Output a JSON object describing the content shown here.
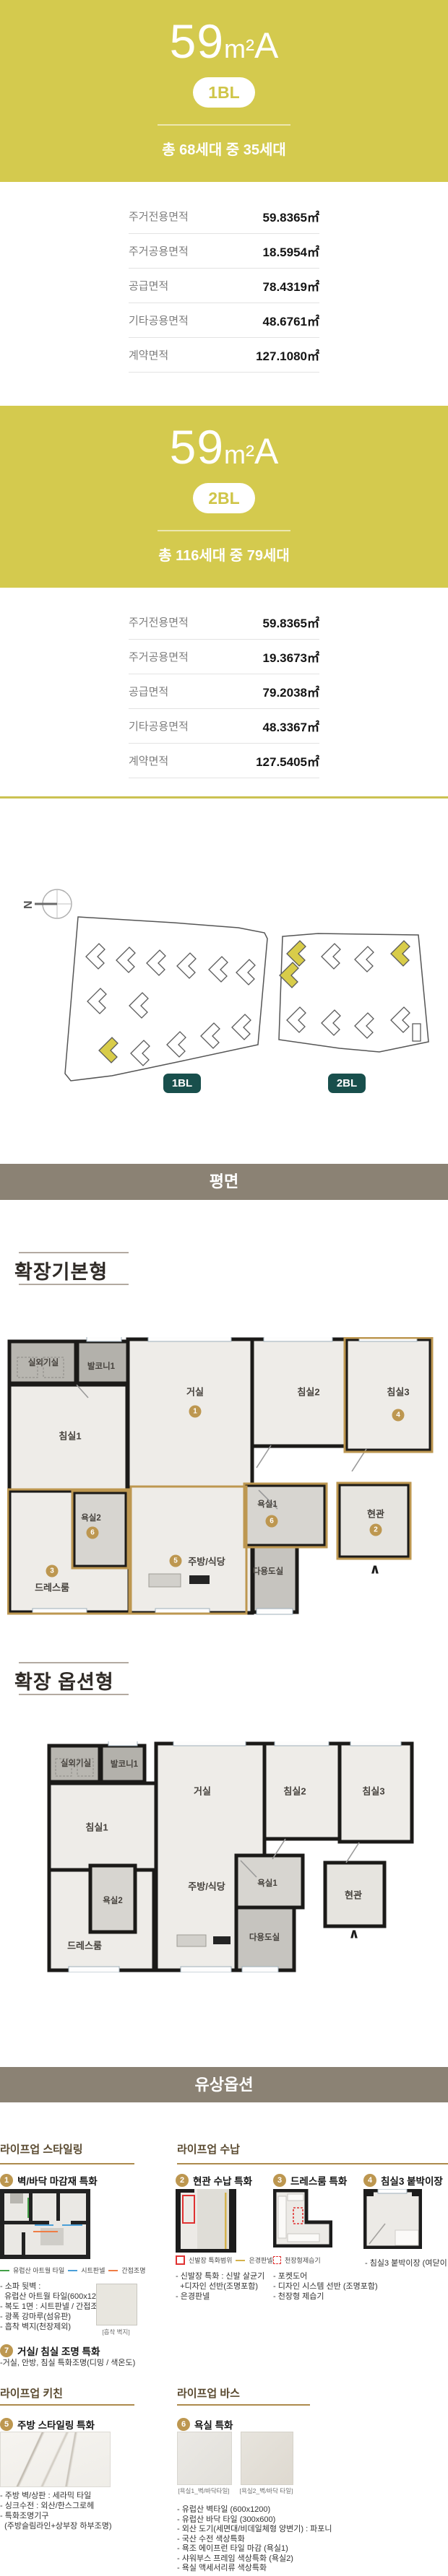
{
  "units": [
    {
      "area_code": "59",
      "area_unit": "m²",
      "type_label": "A",
      "block_badge": "1BL",
      "households": "총 68세대 중 35세대",
      "table": [
        {
          "label": "주거전용면적",
          "value": "59.8365㎡"
        },
        {
          "label": "주거공용면적",
          "value": "18.5954㎡"
        },
        {
          "label": "공급면적",
          "value": "78.4319㎡"
        },
        {
          "label": "기타공용면적",
          "value": "48.6761㎡"
        },
        {
          "label": "계약면적",
          "value": "127.1080㎡"
        }
      ]
    },
    {
      "area_code": "59",
      "area_unit": "m²",
      "type_label": "A",
      "block_badge": "2BL",
      "households": "총 116세대 중 79세대",
      "table": [
        {
          "label": "주거전용면적",
          "value": "59.8365㎡"
        },
        {
          "label": "주거공용면적",
          "value": "19.3673㎡"
        },
        {
          "label": "공급면적",
          "value": "79.2038㎡"
        },
        {
          "label": "기타공용면적",
          "value": "48.3367㎡"
        },
        {
          "label": "계약면적",
          "value": "127.5405㎡"
        }
      ]
    }
  ],
  "site_plan": {
    "north": "N",
    "badge_1": "1BL",
    "badge_2": "2BL"
  },
  "bands": {
    "plan": "평면",
    "paid_options": "유상옵션"
  },
  "floor_plans": [
    {
      "title": "확장기본형",
      "rooms": {
        "ac": "실외기실",
        "balcony": "발코니1",
        "living": "거실",
        "bed1": "침실1",
        "bed2": "침실2",
        "bed3": "침실3",
        "bath2": "욕실2",
        "dress": "드레스룸",
        "kitchen": "주방/식당",
        "bath1": "욕실1",
        "utility": "다용도실",
        "entry": "현관"
      },
      "nums": {
        "living": "1",
        "entry": "2",
        "dress": "3",
        "bed3": "4",
        "kitchen": "5",
        "bath1": "6",
        "bath2": "6"
      }
    },
    {
      "title": "확장 옵션형",
      "rooms": {
        "ac": "실외기실",
        "balcony": "발코니1",
        "living": "거실",
        "bed1": "침실1",
        "bed2": "침실2",
        "bed3": "침실3",
        "bath2": "욕실2",
        "dress": "드레스룸",
        "kitchen": "주방/식당",
        "bath1": "욕실1",
        "utility": "다용도실",
        "entry": "현관"
      }
    }
  ],
  "options": {
    "styling": {
      "header": "라이프업 스타일링",
      "item1": {
        "num": "1",
        "title": "벽/바닥 마감재 특화",
        "legend": [
          {
            "label": "유럽산 아트월 타일",
            "color": "#43a047"
          },
          {
            "label": "시트판넬",
            "color": "#4a9fd8"
          },
          {
            "label": "간접조명",
            "color": "#ef7d45"
          }
        ],
        "bullets": [
          "- 소파 뒷벽 :",
          "  유럽산 아트월 타일(600x1200)",
          "- 복도 1면 : 시트판넬 / 간접조명",
          "- 광폭 강마루(섬유판)",
          "- 흡착 벽지(천장제외)"
        ],
        "swatch_caption": "[흡착 벽지]"
      },
      "item7": {
        "num": "7",
        "title": "거실/ 침실 조명 특화",
        "bullets": [
          "-거실, 안방, 침실 특화조명(디밍 / 색온도)"
        ]
      }
    },
    "storage": {
      "header": "라이프업 수납",
      "item2": {
        "num": "2",
        "title": "현관 수납 특화",
        "legend": [
          {
            "label": "신발장 특화범위"
          },
          {
            "label": "은경판넬"
          }
        ],
        "bullets": [
          "- 신발장 특화 : 신발 살균기",
          "  +디자인 선반(조명포함)",
          "- 은경판넬"
        ]
      },
      "item3": {
        "num": "3",
        "title": "드레스룸 특화",
        "legend": [
          {
            "label": "천장형제습기"
          }
        ],
        "bullets": [
          "- 포켓도어",
          "- 디자인 시스템 선반 (조명포함)",
          "- 천장형 제습기"
        ]
      },
      "item4": {
        "num": "4",
        "title": "침실3 붙박이장",
        "bullets": [
          "- 침실3 붙박이장 (여닫이 도어)"
        ]
      }
    },
    "kitchen": {
      "header": "라이프업 키친",
      "item5": {
        "num": "5",
        "title": "주방 스타일링 특화",
        "bullets": [
          "- 주방 벽/상판 : 세라믹 타일",
          "- 싱크수전 : 외산/한스그로헤",
          "- 특화조명기구",
          "  (주방슬림라인+상부장 하부조명)"
        ]
      }
    },
    "bath": {
      "header": "라이프업 바스",
      "item6": {
        "num": "6",
        "title": "욕실 특화",
        "captions": [
          "[욕실1_벽/바닥타일]",
          "[욕실2_벽/바닥 타일]"
        ],
        "bullets": [
          "- 유럽산 벽타일 (600x1200)",
          "- 유럽산 바닥 타일 (300x600)",
          "- 외산 도기(세면대/비데일체형 양변기) : 파포니",
          "- 국산 수전 색상특화",
          "- 욕조 에이프런 타일 마감 (욕실1)",
          "- 샤워부스 프레임 색상특화 (욕실2)",
          "- 욕실 액세서리류 색상특화"
        ]
      }
    }
  }
}
